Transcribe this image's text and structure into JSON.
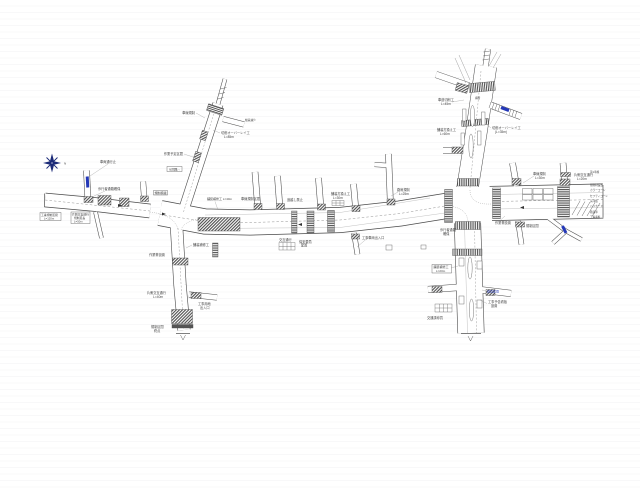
{
  "colors": {
    "line": "#4a4a4a",
    "label": "#444444",
    "faint": "#8a8a8a",
    "blue": "#2438b8",
    "compass": "#1b2a78",
    "hatch": "#4d4d4d"
  },
  "compass": {
    "label": "N",
    "x": 64,
    "y": 164.5
  },
  "drawing": {
    "labels": [
      {
        "text": "車両通行止",
        "x": 100,
        "y": 163
      },
      {
        "text": "工事規制区間",
        "x": 41,
        "y": 216,
        "size": 2.8
      },
      {
        "text": "L=120m",
        "x": 44,
        "y": 219.6,
        "size": 2.8
      },
      {
        "text": "片側交互通行",
        "x": 72,
        "y": 215.5,
        "size": 2.8
      },
      {
        "text": "規制延長",
        "x": 74,
        "y": 219,
        "size": 2.8
      },
      {
        "text": "L=50m",
        "x": 74,
        "y": 222.5,
        "size": 2.8
      },
      {
        "text": "歩行者通路確保",
        "x": 98,
        "y": 190
      },
      {
        "text": "車線規制",
        "x": 195,
        "y": 114,
        "anchor": "end"
      },
      {
        "text": "作業予定区間",
        "x": 183,
        "y": 155,
        "anchor": "end"
      },
      {
        "text": "う回路→",
        "x": 168.5,
        "y": 170.3,
        "size": 3
      },
      {
        "text": "切削オーバーレイ工",
        "x": 221,
        "y": 134
      },
      {
        "text": "L=85m",
        "x": 224,
        "y": 138
      },
      {
        "text": "規制標識",
        "x": 154.5,
        "y": 194,
        "size": 3
      },
      {
        "text": "幅員減少",
        "x": 245,
        "y": 121,
        "size": 2.8
      },
      {
        "text": "舗装補修工 L=40m",
        "x": 207,
        "y": 200,
        "size": 3
      },
      {
        "text": "車線規制区間",
        "x": 241,
        "y": 200
      },
      {
        "text": "追越し禁止",
        "x": 287,
        "y": 201
      },
      {
        "text": "舗装打換え工",
        "x": 331,
        "y": 195
      },
      {
        "text": "L=30m",
        "x": 333,
        "y": 199
      },
      {
        "text": "路肩規制",
        "x": 397,
        "y": 191
      },
      {
        "text": "L=25m",
        "x": 399,
        "y": 195
      },
      {
        "text": "交互通行",
        "x": 279,
        "y": 241
      },
      {
        "text": "保安要員",
        "x": 299,
        "y": 243
      },
      {
        "text": "配置",
        "x": 301,
        "y": 246.5
      },
      {
        "text": "工事車両出入口",
        "x": 362,
        "y": 239
      },
      {
        "text": "車道切削工",
        "x": 438,
        "y": 101
      },
      {
        "text": "L=45m",
        "x": 441,
        "y": 105
      },
      {
        "text": "舗装打換え工",
        "x": 437,
        "y": 131
      },
      {
        "text": "L=60m",
        "x": 440,
        "y": 135
      },
      {
        "text": "切削オーバーレイ工",
        "x": 492,
        "y": 129
      },
      {
        "text": "(L=35m)",
        "x": 495,
        "y": 133
      },
      {
        "text": "横断",
        "x": 475,
        "y": 99,
        "size": 2.6
      },
      {
        "text": "車線規制",
        "x": 533,
        "y": 175
      },
      {
        "text": "L=30m",
        "x": 535,
        "y": 179
      },
      {
        "text": "片側交互通行",
        "x": 574,
        "y": 176
      },
      {
        "text": "L=20m",
        "x": 577,
        "y": 180
      },
      {
        "text": "歩行者通路",
        "x": 440,
        "y": 231
      },
      {
        "text": "確保",
        "x": 443,
        "y": 235
      },
      {
        "text": "作業帯設置",
        "x": 495,
        "y": 224
      },
      {
        "text": "規制区間",
        "x": 526,
        "y": 227
      },
      {
        "text": "第1車線",
        "x": 590,
        "y": 173,
        "size": 2.6
      },
      {
        "text": "規制材設置",
        "x": 590,
        "y": 186,
        "size": 2.6
      },
      {
        "text": "カラーコーン",
        "x": 590,
        "y": 191,
        "size": 2.6
      },
      {
        "text": "セフティコーン",
        "x": 590,
        "y": 197,
        "size": 2.6
      },
      {
        "text": "矢印板",
        "x": 590,
        "y": 202,
        "size": 2.6
      },
      {
        "text": "バリケード",
        "x": 590,
        "y": 207,
        "size": 2.6
      },
      {
        "text": "標識車",
        "x": 590,
        "y": 213,
        "size": 2.6
      },
      {
        "text": "工事看板",
        "x": 590,
        "y": 218,
        "size": 2.6
      },
      {
        "text": "舗装補修工",
        "x": 433.5,
        "y": 268,
        "size": 3
      },
      {
        "text": "L=20m",
        "x": 436,
        "y": 271.8,
        "size": 3
      },
      {
        "text": "交通誘導員",
        "x": 427,
        "y": 319
      },
      {
        "text": "工事予告看板",
        "x": 488,
        "y": 303
      },
      {
        "text": "設置",
        "x": 491,
        "y": 307
      },
      {
        "text": "調査区間",
        "x": 487,
        "y": 292.3,
        "size": 3,
        "color": "#2438b8"
      },
      {
        "text": "作業帯設置",
        "x": 165,
        "y": 256,
        "anchor": "end"
      },
      {
        "text": "片側交互通行",
        "x": 166,
        "y": 294,
        "anchor": "end"
      },
      {
        "text": "L=40m",
        "x": 163,
        "y": 298,
        "anchor": "end"
      },
      {
        "text": "舗装補修工",
        "x": 193,
        "y": 246
      },
      {
        "text": "工事用地",
        "x": 198,
        "y": 305
      },
      {
        "text": "出入口",
        "x": 200,
        "y": 309
      },
      {
        "text": "規制区間",
        "x": 151,
        "y": 328
      },
      {
        "text": "終点",
        "x": 154,
        "y": 332
      }
    ],
    "leaders": [
      {
        "x1": 108,
        "y1": 164,
        "x2": 90,
        "y2": 176
      },
      {
        "x1": 196,
        "y1": 113,
        "x2": 205,
        "y2": 118
      },
      {
        "x1": 184,
        "y1": 154,
        "x2": 196,
        "y2": 158
      },
      {
        "x1": 220,
        "y1": 133,
        "x2": 213,
        "y2": 130
      },
      {
        "x1": 215,
        "y1": 201.5,
        "x2": 218,
        "y2": 210
      },
      {
        "x1": 398,
        "y1": 192,
        "x2": 391,
        "y2": 196
      },
      {
        "x1": 370,
        "y1": 236,
        "x2": 357,
        "y2": 247
      },
      {
        "x1": 452,
        "y1": 102,
        "x2": 464,
        "y2": 100
      },
      {
        "x1": 491,
        "y1": 128,
        "x2": 486,
        "y2": 124
      },
      {
        "x1": 534,
        "y1": 176,
        "x2": 523,
        "y2": 183
      },
      {
        "x1": 500,
        "y1": 220.5,
        "x2": 505,
        "y2": 216
      },
      {
        "x1": 451,
        "y1": 268,
        "x2": 458,
        "y2": 266
      },
      {
        "x1": 487,
        "y1": 303.5,
        "x2": 480,
        "y2": 300
      },
      {
        "x1": 486,
        "y1": 291,
        "x2": 482,
        "y2": 290
      },
      {
        "x1": 192,
        "y1": 245,
        "x2": 186,
        "y2": 248
      },
      {
        "x1": 105,
        "y1": 191,
        "x2": 92,
        "y2": 197
      }
    ],
    "boxes": [
      {
        "x": 40,
        "y": 212.5,
        "w": 21,
        "h": 8
      },
      {
        "x": 71,
        "y": 212,
        "w": 19,
        "h": 11.5
      },
      {
        "x": 167,
        "y": 166.5,
        "w": 15,
        "h": 5
      },
      {
        "x": 153.5,
        "y": 190.5,
        "w": 14,
        "h": 4.5
      },
      {
        "x": 432,
        "y": 264.5,
        "w": 19.5,
        "h": 8.5
      },
      {
        "x": 386,
        "y": 245,
        "w": 6,
        "h": 5
      },
      {
        "x": 421,
        "y": 245,
        "w": 5,
        "h": 4
      }
    ],
    "tables": [
      {
        "x": 332,
        "y": 200.5,
        "w": 12,
        "h": 5,
        "cols": 3,
        "rows": 2
      },
      {
        "x": 279,
        "y": 242.5,
        "w": 16,
        "h": 7.5,
        "cols": 4,
        "rows": 2
      },
      {
        "x": 435,
        "y": 304,
        "w": 17,
        "h": 8,
        "cols": 4,
        "rows": 2
      }
    ]
  }
}
